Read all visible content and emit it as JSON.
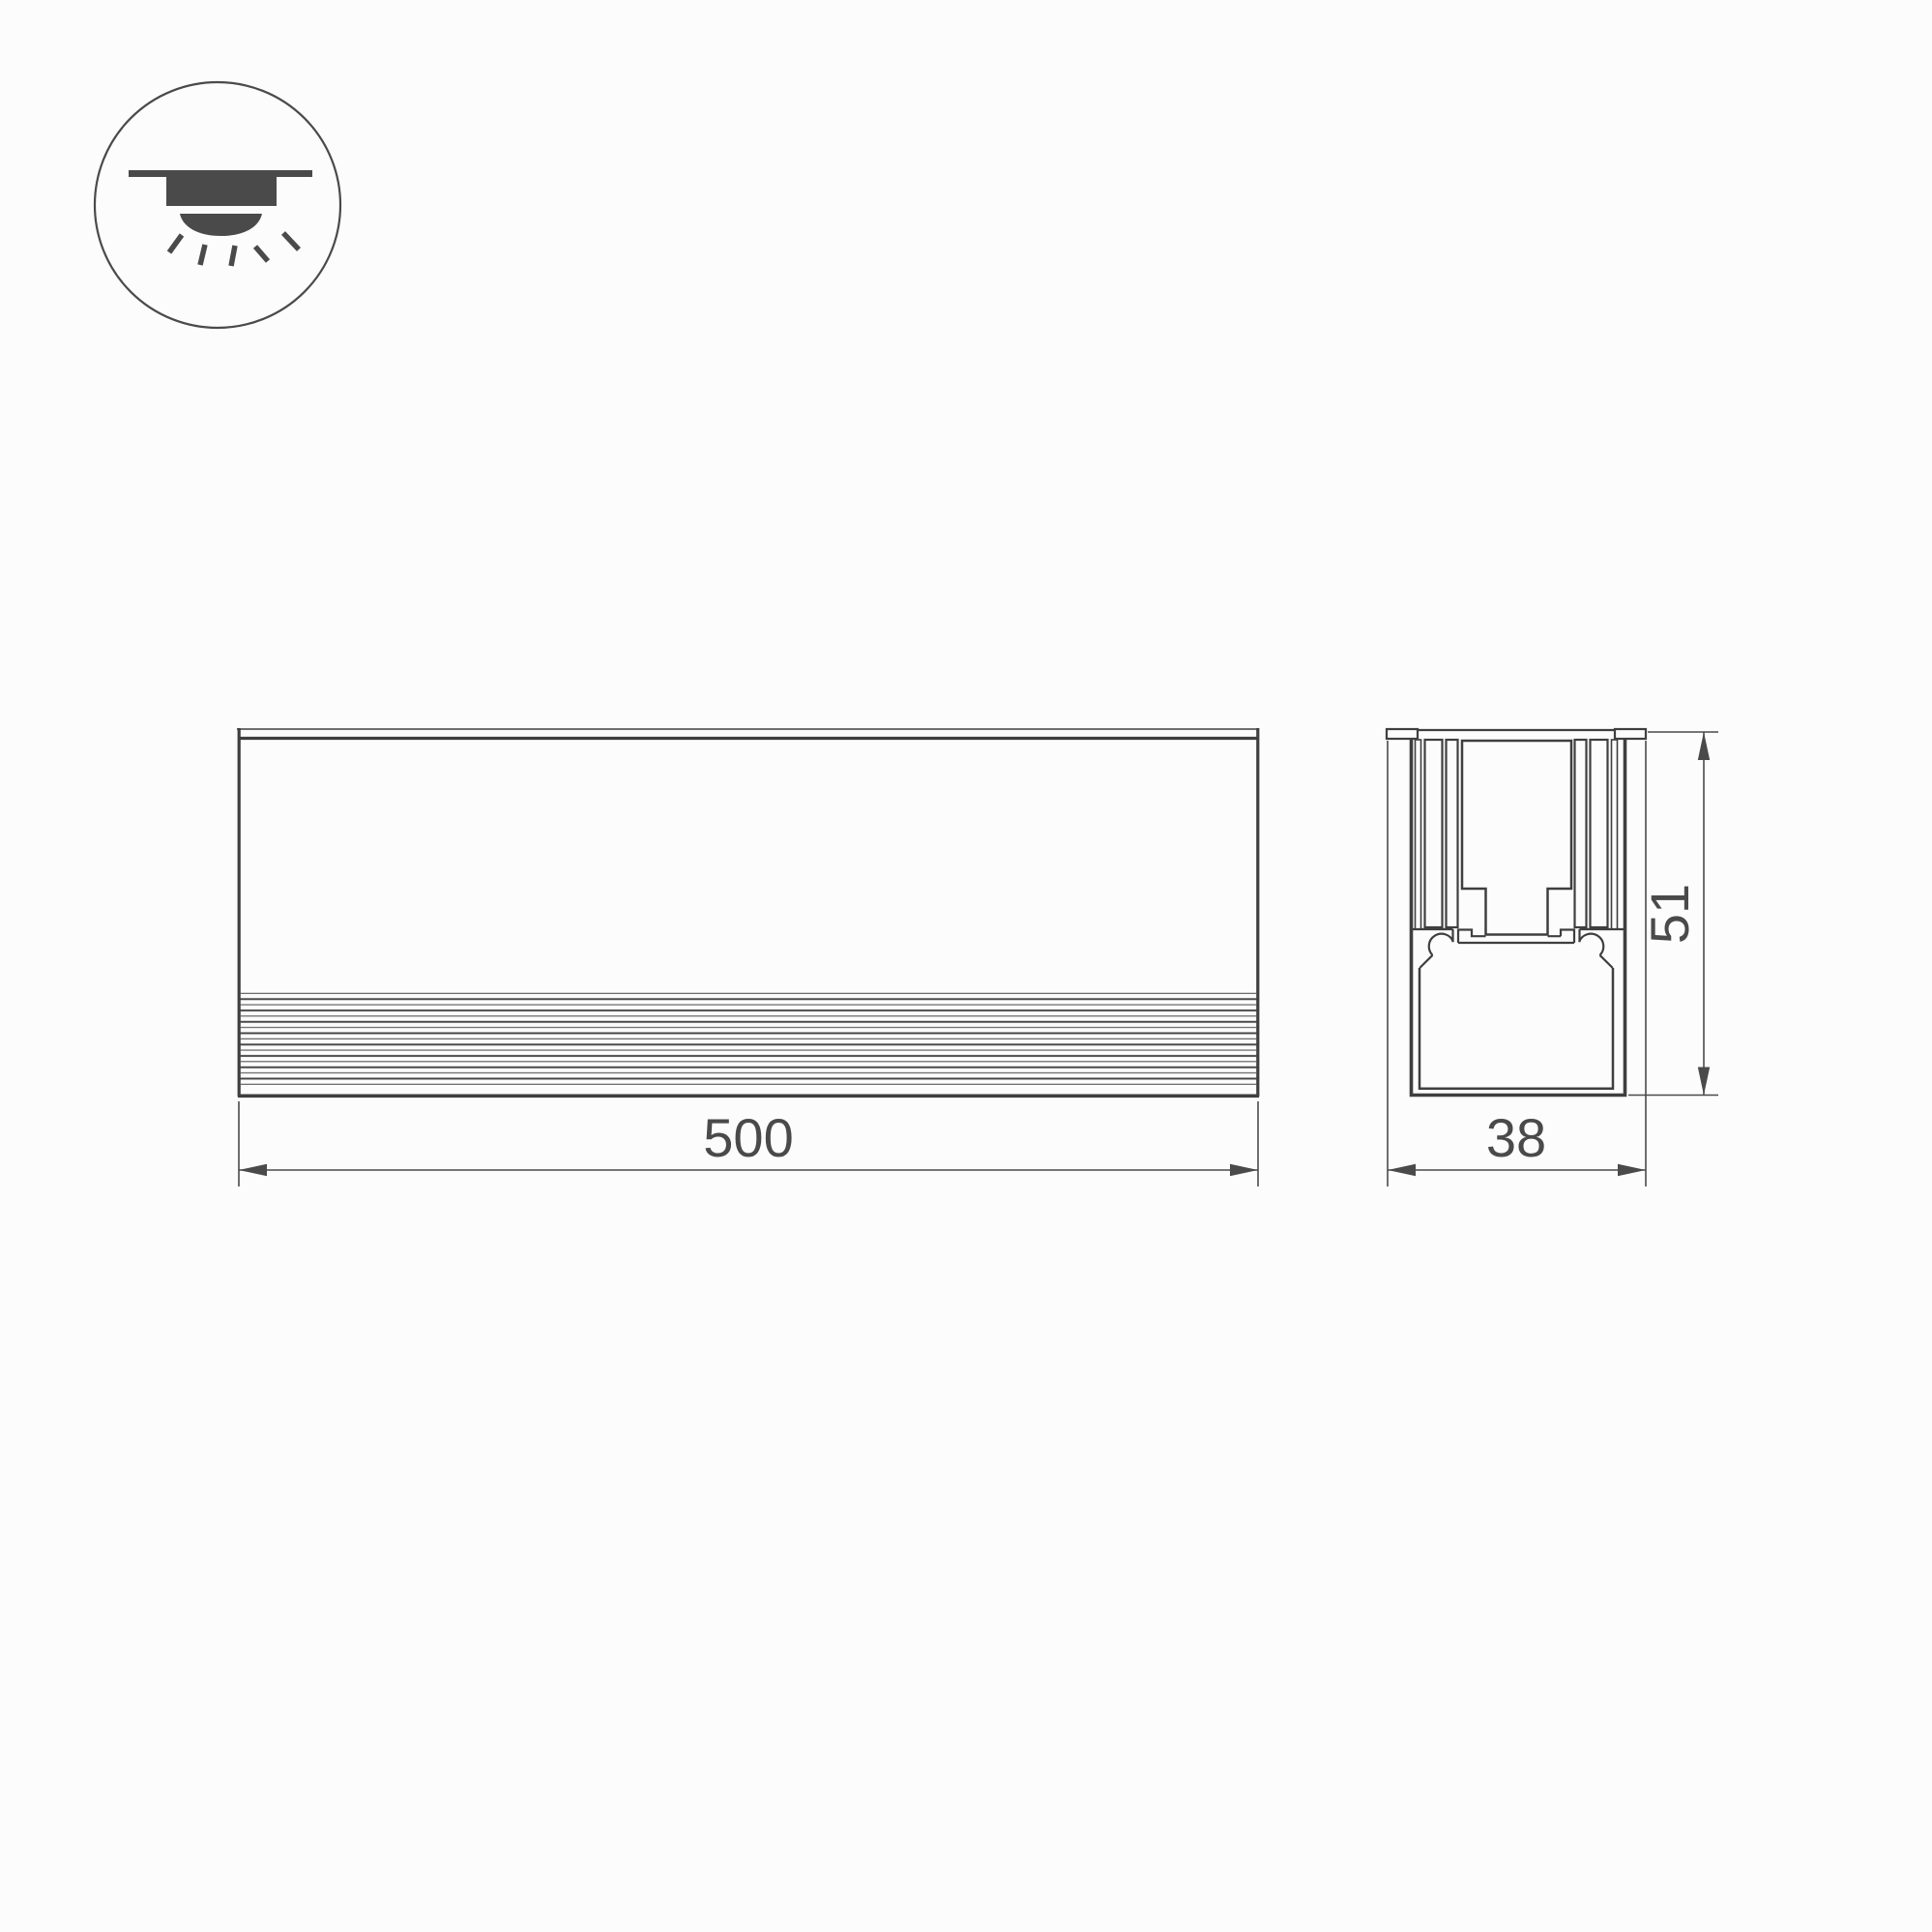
{
  "page": {
    "background": "#fcfcfc",
    "type_label": "dimensional-drawing"
  },
  "colors": {
    "object_line": "#3f3f3f",
    "dimension_line": "#4a4a4a",
    "icon": "#4a4a4b"
  },
  "icon": {
    "name": "recessed-ceiling-light",
    "meaning": "recessed mount luminaire with downlight rays"
  },
  "dims": {
    "length": "500",
    "width": "38",
    "height": "51"
  }
}
